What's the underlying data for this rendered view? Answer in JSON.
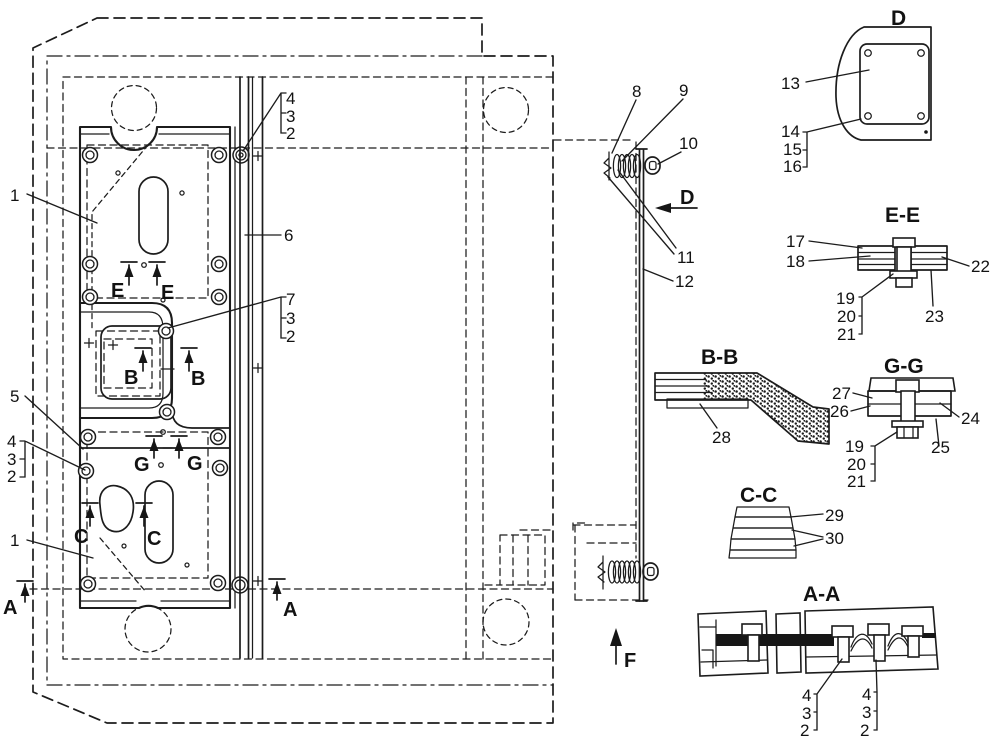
{
  "main_view": {
    "callouts": {
      "c1_top": "1",
      "c1_bottom": "1",
      "c5": "5",
      "c6": "6",
      "c8": "8",
      "c9": "9",
      "c10": "10",
      "c11": "11",
      "c12": "12"
    },
    "brackets": {
      "top_right": [
        "4",
        "3",
        "2"
      ],
      "mid_right": [
        "7",
        "3",
        "2"
      ],
      "left": [
        "4",
        "3",
        "2"
      ]
    },
    "section_markers": {
      "e1": "E",
      "e2": "E",
      "b1": "B",
      "b2": "B",
      "g1": "G",
      "g2": "G",
      "c1": "C",
      "c2": "C",
      "a1": "A",
      "a2": "A"
    },
    "view_arrows": {
      "d": "D",
      "f": "F"
    }
  },
  "details": {
    "d": {
      "title": "D",
      "callouts": {
        "c13": "13",
        "c14": "14",
        "c15": "15",
        "c16": "16"
      }
    },
    "ee": {
      "title": "E-E",
      "callouts": {
        "c17": "17",
        "c18": "18",
        "c22": "22",
        "c23": "23"
      },
      "bracket": [
        "19",
        "20",
        "21"
      ]
    },
    "bb": {
      "title": "B-B",
      "callouts": {
        "c28": "28"
      }
    },
    "gg": {
      "title": "G-G",
      "callouts": {
        "c27": "27",
        "c26": "26",
        "c24": "24",
        "c25": "25"
      },
      "bracket": [
        "19",
        "20",
        "21"
      ]
    },
    "cc": {
      "title": "C-C",
      "callouts": {
        "c29": "29",
        "c30": "30"
      }
    },
    "aa": {
      "title": "A-A",
      "bracket_left": [
        "4",
        "3",
        "2"
      ],
      "bracket_right": [
        "4",
        "3",
        "2"
      ]
    }
  }
}
